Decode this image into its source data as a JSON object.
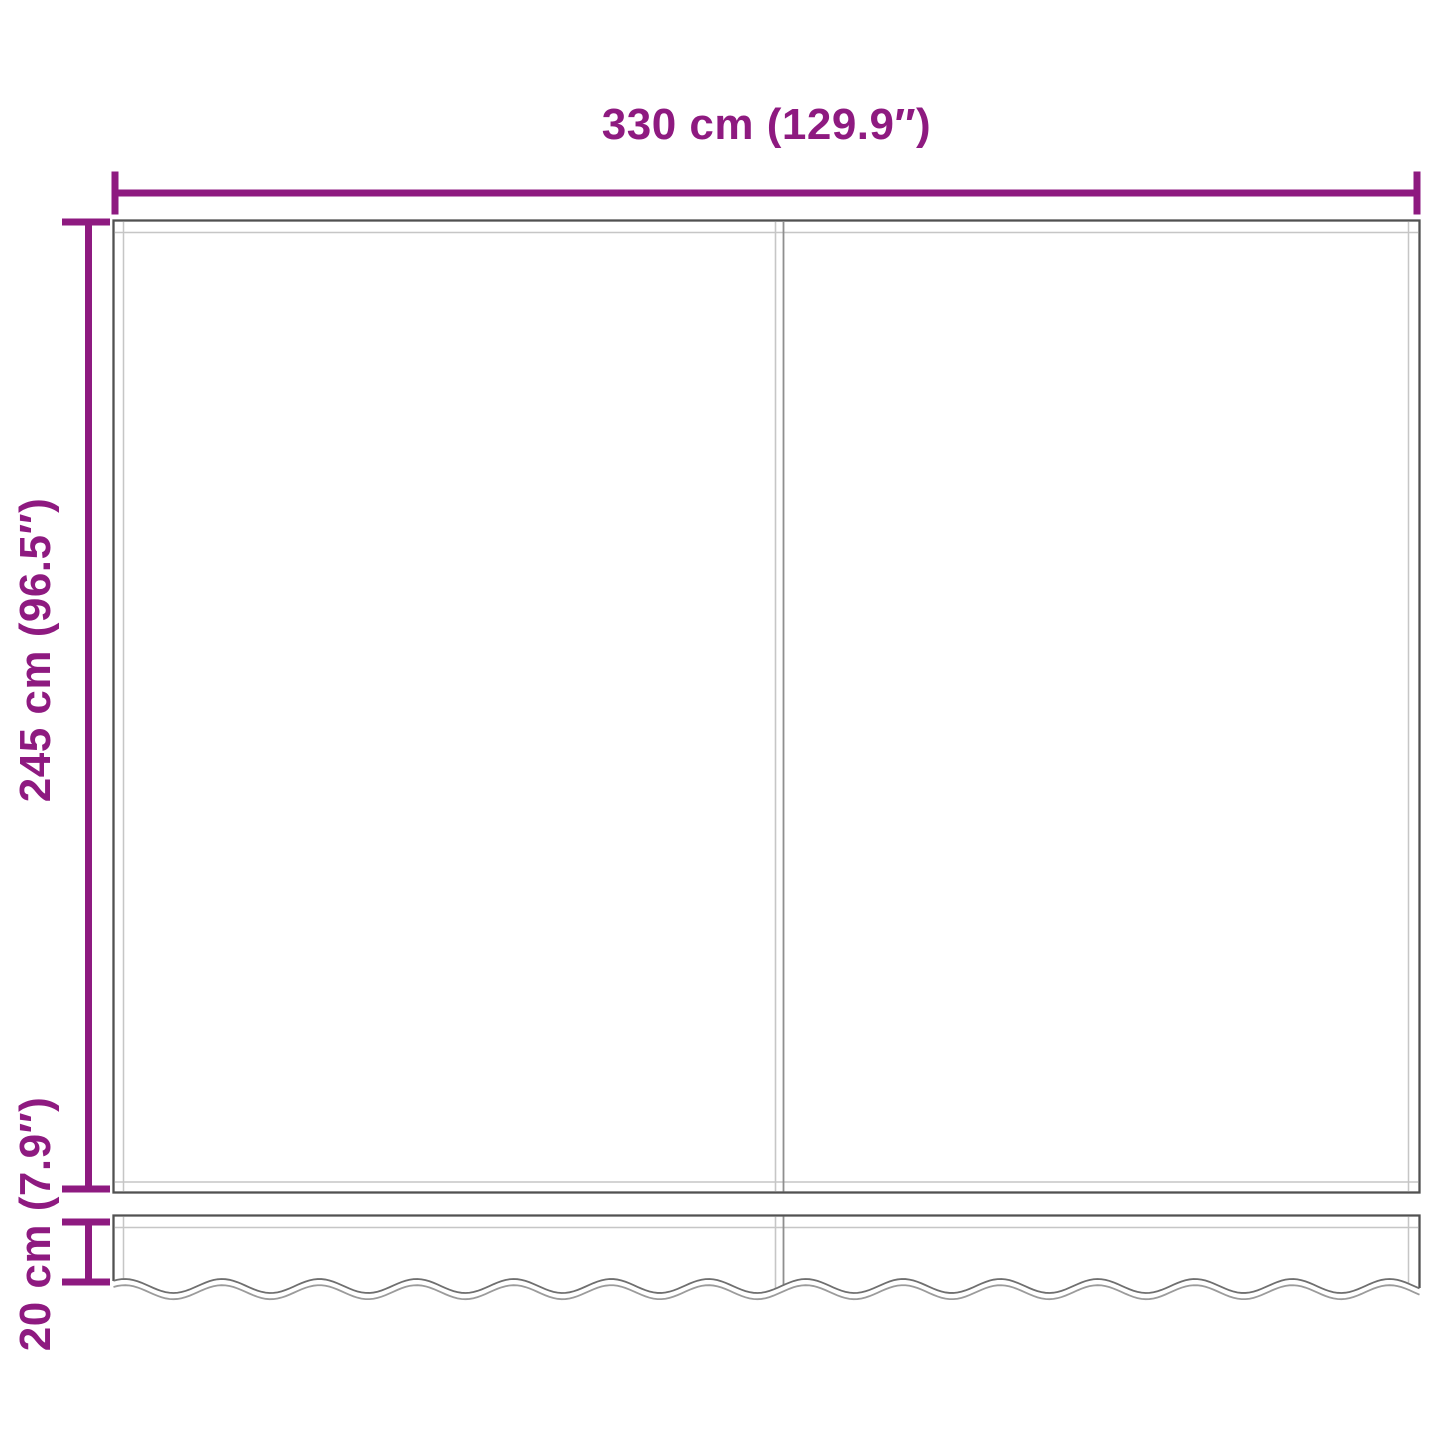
{
  "diagram": {
    "colors": {
      "accent": "#8E1A80",
      "outline": "#515151",
      "seam": "#C6C6C6",
      "divider_light": "#C6C6C6",
      "divider_dark": "#8F8F8F",
      "wave_outer": "#6F6F6F",
      "wave_inner": "#9B9B9B",
      "background": "#FFFFFF"
    },
    "dimensions": {
      "width": {
        "label": "330 cm (129.9″)",
        "cm": 330,
        "inches": 129.9
      },
      "height": {
        "label": "245 cm (96.5″)",
        "cm": 245,
        "inches": 96.5
      },
      "valance_height": {
        "label": "20 cm (7.9″)",
        "cm": 20,
        "inches": 7.9
      }
    }
  }
}
